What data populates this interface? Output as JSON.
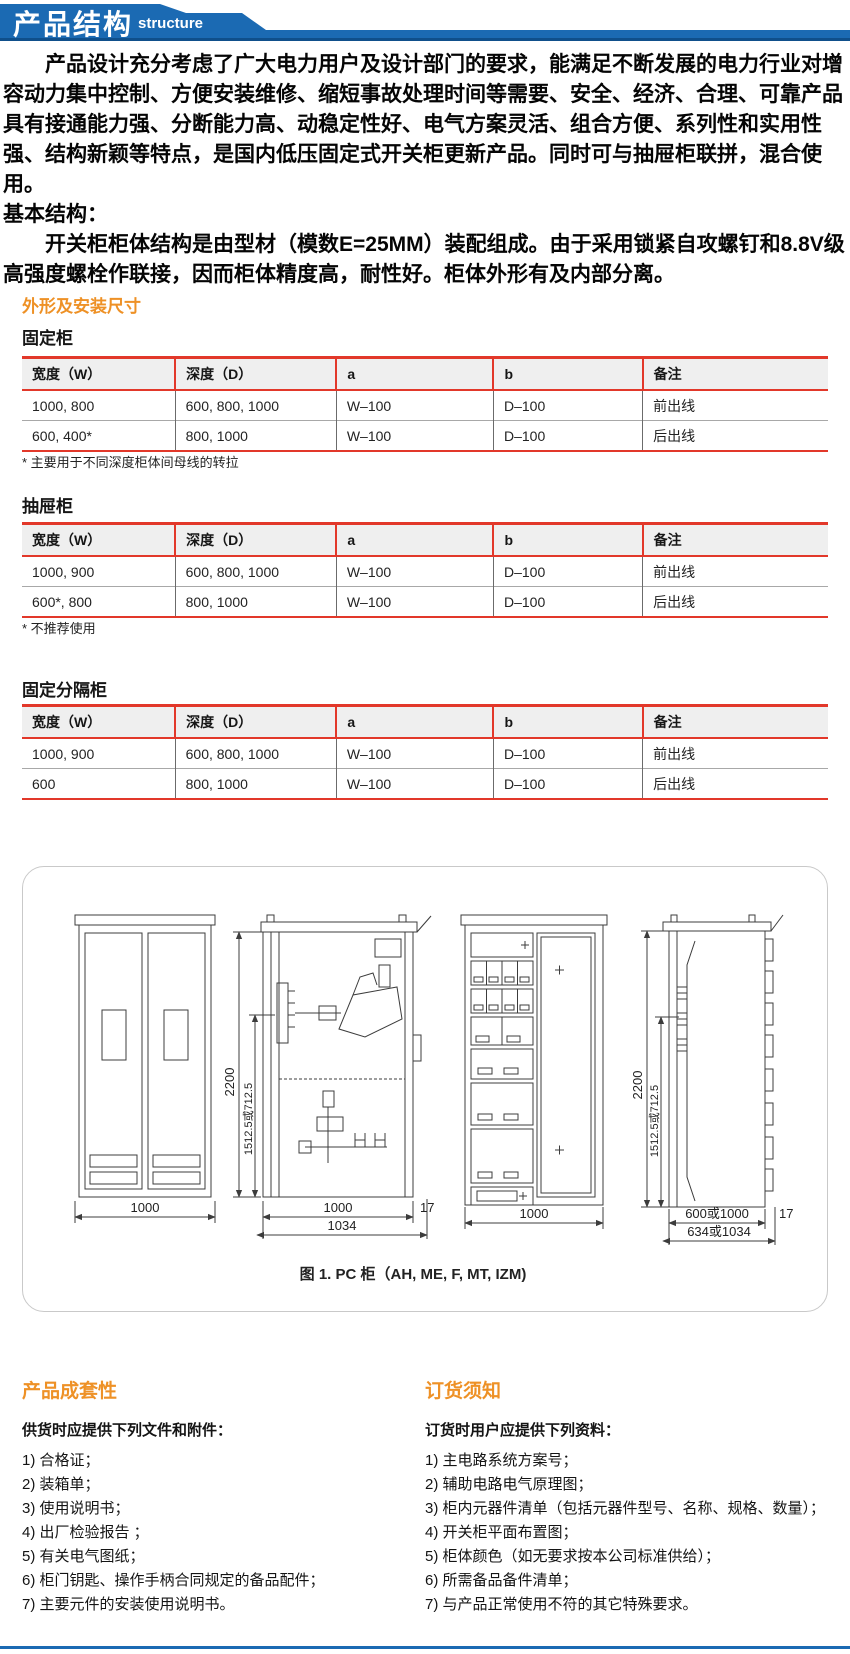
{
  "colors": {
    "banner_blue": "#1b6ab3",
    "banner_dark_blue": "#0f4f8b",
    "accent_orange": "#ee9126",
    "table_line_red": "#e2382a",
    "header_row_gray": "#efefef"
  },
  "banner": {
    "title": "产品结构",
    "subtitle": "structure"
  },
  "intro": {
    "para1": "产品设计充分考虑了广大电力用户及设计部门的要求，能满足不断发展的电力行业对增容动力集中控制、方便安装维修、缩短事故处理时间等需要、安全、经济、合理、可靠产品具有接通能力强、分断能力高、动稳定性好、电气方案灵活、组合方便、系列性和实用性强、结构新颖等特点，是国内低压固定式开关柜更新产品。同时可与抽屉柜联拼，混合使用。",
    "heading2": "基本结构：",
    "para2": "开关柜柜体结构是由型材（模数E=25MM）装配组成。由于采用锁紧自攻螺钉和8.8V级高强度螺栓作联接，因而柜体精度高，耐性好。柜体外形有及内部分离。"
  },
  "specs": {
    "heading": "外形及安装尺寸",
    "tables": [
      {
        "title": "固定柜",
        "headers": [
          "宽度（W）",
          "深度（D）",
          "a",
          "b",
          "备注"
        ],
        "rows": [
          [
            "1000, 800",
            "600, 800, 1000",
            "W–100",
            "D–100",
            "前出线"
          ],
          [
            "600, 400*",
            "800, 1000",
            "W–100",
            "D–100",
            "后出线"
          ]
        ],
        "footnote": "* 主要用于不同深度柜体间母线的转拉"
      },
      {
        "title": "抽屉柜",
        "headers": [
          "宽度（W）",
          "深度（D）",
          "a",
          "b",
          "备注"
        ],
        "rows": [
          [
            "1000, 900",
            "600, 800, 1000",
            "W–100",
            "D–100",
            "前出线"
          ],
          [
            "600*, 800",
            "800, 1000",
            "W–100",
            "D–100",
            "后出线"
          ]
        ],
        "footnote": "* 不推荐使用"
      },
      {
        "title": "固定分隔柜",
        "headers": [
          "宽度（W）",
          "深度（D）",
          "a",
          "b",
          "备注"
        ],
        "rows": [
          [
            "1000, 900",
            "600, 800, 1000",
            "W–100",
            "D–100",
            "前出线"
          ],
          [
            "600",
            "800, 1000",
            "W–100",
            "D–100",
            "后出线"
          ]
        ],
        "footnote": ""
      }
    ]
  },
  "figure": {
    "caption": "图 1. PC 柜（AH, ME, F, MT, IZM)",
    "dims": {
      "front_width": "1000",
      "height": "2200",
      "busbar_height": "1512.5或712.5",
      "depth": "1000",
      "frame": "17",
      "depth_total": "1034",
      "drawer_width": "1000",
      "depth2": "600或1000",
      "depth2_total": "634或1034"
    }
  },
  "kits": {
    "heading": "产品成套性",
    "intro": "供货时应提供下列文件和附件：",
    "items": [
      "1) 合格证；",
      "2) 装箱单；",
      "3) 使用说明书；",
      "4) 出厂检验报告 ；",
      "5) 有关电气图纸；",
      "6) 柜门钥匙、操作手柄合同规定的备品配件；",
      "7) 主要元件的安装使用说明书。"
    ]
  },
  "ordering": {
    "heading": "订货须知",
    "intro": "订货时用户应提供下列资料：",
    "items": [
      "1) 主电路系统方案号；",
      "2)  辅助电路电气原理图；",
      "3) 柜内元器件清单（包括元器件型号、名称、规格、数量）；",
      "4) 开关柜平面布置图；",
      "5) 柜体颜色（如无要求按本公司标准供给）；",
      "6) 所需备品备件清单；",
      "7) 与产品正常使用不符的其它特殊要求。"
    ]
  }
}
